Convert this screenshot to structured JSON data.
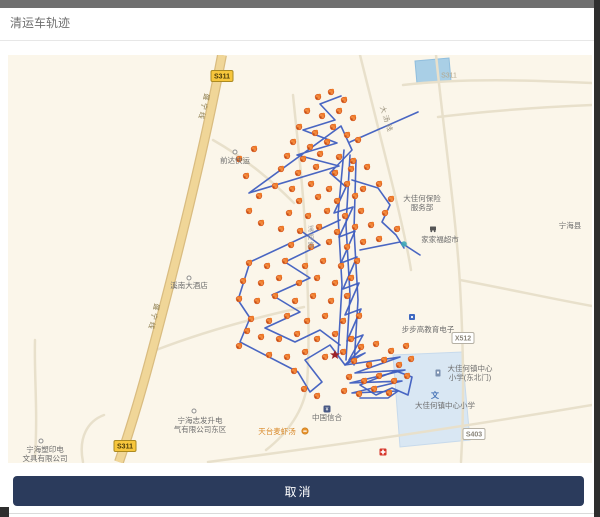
{
  "header": {
    "title": "清运车轨迹"
  },
  "footer": {
    "cancel_label": "取消"
  },
  "map": {
    "background": "#fbf6ea",
    "trajectory_color": "#3f5ec0",
    "marker_color": "#f28a3e",
    "road_badges": [
      {
        "label": "S311",
        "type": "provincial",
        "x": 214,
        "y": 21
      },
      {
        "label": "S311",
        "type": "provincial",
        "x": 117,
        "y": 391
      },
      {
        "label": "S311",
        "type": "plain",
        "x": 441,
        "y": 20
      },
      {
        "label": "X512",
        "type": "county",
        "x": 455,
        "y": 283
      },
      {
        "label": "S403",
        "type": "county",
        "x": 466,
        "y": 379
      }
    ],
    "road_names": [
      {
        "text": "盛宁线",
        "x": 197,
        "y": 38,
        "angle": 104,
        "vertical": false,
        "color": "#8a7a4a"
      },
      {
        "text": "盛宁线",
        "x": 147,
        "y": 248,
        "angle": 104,
        "vertical": false,
        "color": "#8a7a4a"
      },
      {
        "text": "大汤线",
        "x": 372,
        "y": 52,
        "angle": 72,
        "vertical": false,
        "color": "#9a917c"
      },
      {
        "text": "溪南路",
        "x": 303,
        "y": 176,
        "angle": 0,
        "vertical": true,
        "color": "#9a9a9a"
      }
    ],
    "poi_labels": [
      {
        "lines": [
          "前达快运"
        ],
        "x": 227,
        "y": 108,
        "icon": "poi-dot"
      },
      {
        "lines": [
          "大佳何保险",
          "服务部"
        ],
        "x": 414,
        "y": 146,
        "icon": null
      },
      {
        "lines": [
          "家家福超市"
        ],
        "x": 432,
        "y": 187,
        "icon": "cart",
        "icon_x": 425,
        "icon_y": 174
      },
      {
        "lines": [
          "宁海县"
        ],
        "x": 562,
        "y": 173,
        "icon": null
      },
      {
        "lines": [
          "溪南大酒店"
        ],
        "x": 181,
        "y": 233,
        "icon": "poi-dot",
        "icon_x": 181,
        "icon_y": 223
      },
      {
        "lines": [
          "步步高教育电子"
        ],
        "x": 420,
        "y": 277,
        "icon": "edu",
        "icon_x": 404,
        "icon_y": 262
      },
      {
        "lines": [
          "大佳何镇中心",
          "小学(东北门)"
        ],
        "x": 462,
        "y": 316,
        "icon": "gate",
        "icon_x": 430,
        "icon_y": 318
      },
      {
        "lines": [
          "大佳何镇中心小学"
        ],
        "x": 437,
        "y": 353,
        "icon": "school",
        "icon_x": 427,
        "icon_y": 340
      },
      {
        "lines": [
          "中国信合"
        ],
        "x": 319,
        "y": 365,
        "icon": "bank"
      },
      {
        "lines": [
          "天台麦虾汤"
        ],
        "x": 269,
        "y": 379,
        "icon": "food",
        "icon_x": 297,
        "icon_y": 376,
        "color": "#d98a2b"
      },
      {
        "lines": [
          "宁海志发升电",
          "气有限公司东区"
        ],
        "x": 192,
        "y": 368,
        "icon": "poi-dot",
        "icon_x": 186,
        "icon_y": 356
      },
      {
        "lines": [
          "宁海塑印电",
          "文具有限公司"
        ],
        "x": 37,
        "y": 397,
        "icon": "poi-dot",
        "icon_x": 33,
        "icon_y": 386
      }
    ],
    "point_icons": [
      {
        "type": "star",
        "x": 327,
        "y": 300
      },
      {
        "type": "pharmacy",
        "x": 375,
        "y": 397
      },
      {
        "type": "water-dot",
        "x": 396,
        "y": 189
      }
    ],
    "trajectory_paths": [
      [
        [
          333,
          41
        ],
        [
          312,
          49
        ],
        [
          327,
          65
        ],
        [
          295,
          75
        ],
        [
          329,
          88
        ],
        [
          289,
          100
        ],
        [
          331,
          111
        ],
        [
          241,
          138
        ],
        [
          333,
          71
        ],
        [
          344,
          95
        ],
        [
          322,
          118
        ],
        [
          338,
          132
        ],
        [
          326,
          158
        ],
        [
          345,
          152
        ],
        [
          331,
          182
        ],
        [
          347,
          176
        ],
        [
          333,
          208
        ],
        [
          349,
          202
        ],
        [
          335,
          234
        ],
        [
          351,
          228
        ],
        [
          337,
          260
        ],
        [
          353,
          254
        ],
        [
          339,
          286
        ],
        [
          355,
          280
        ],
        [
          341,
          305
        ],
        [
          357,
          298
        ],
        [
          337,
          310
        ],
        [
          392,
          302
        ],
        [
          347,
          318
        ],
        [
          397,
          315
        ],
        [
          342,
          328
        ],
        [
          394,
          326
        ],
        [
          344,
          338
        ],
        [
          390,
          336
        ],
        [
          380,
          343
        ],
        [
          352,
          343
        ]
      ],
      [
        [
          332,
          165
        ],
        [
          242,
          207
        ],
        [
          230,
          245
        ],
        [
          242,
          263
        ],
        [
          232,
          287
        ],
        [
          290,
          317
        ],
        [
          302,
          337
        ],
        [
          314,
          327
        ],
        [
          297,
          305
        ],
        [
          322,
          290
        ],
        [
          337,
          310
        ],
        [
          352,
          295
        ]
      ],
      [
        [
          292,
          175
        ],
        [
          312,
          190
        ],
        [
          277,
          207
        ],
        [
          302,
          223
        ],
        [
          264,
          240
        ],
        [
          292,
          257
        ],
        [
          257,
          273
        ],
        [
          287,
          287
        ],
        [
          312,
          275
        ],
        [
          332,
          290
        ]
      ],
      [
        [
          342,
          87
        ],
        [
          410,
          57
        ]
      ],
      [
        [
          344,
          125
        ],
        [
          370,
          133
        ],
        [
          382,
          150
        ],
        [
          374,
          167
        ],
        [
          388,
          180
        ],
        [
          396,
          193
        ]
      ],
      [
        [
          352,
          195
        ],
        [
          392,
          187
        ],
        [
          412,
          200
        ]
      ],
      [
        [
          336,
          95
        ],
        [
          330,
          160
        ],
        [
          334,
          230
        ],
        [
          330,
          300
        ]
      ],
      [
        [
          342,
          100
        ],
        [
          338,
          170
        ],
        [
          342,
          240
        ],
        [
          338,
          305
        ]
      ],
      [
        [
          348,
          105
        ],
        [
          346,
          175
        ],
        [
          350,
          245
        ],
        [
          346,
          310
        ]
      ],
      [
        [
          352,
          330
        ],
        [
          368,
          340
        ],
        [
          384,
          333
        ],
        [
          400,
          340
        ],
        [
          404,
          322
        ],
        [
          388,
          316
        ],
        [
          372,
          322
        ],
        [
          352,
          330
        ]
      ]
    ],
    "markers": [
      [
        310,
        42
      ],
      [
        323,
        37
      ],
      [
        336,
        45
      ],
      [
        299,
        56
      ],
      [
        314,
        61
      ],
      [
        331,
        56
      ],
      [
        345,
        63
      ],
      [
        291,
        72
      ],
      [
        307,
        78
      ],
      [
        325,
        72
      ],
      [
        339,
        80
      ],
      [
        285,
        87
      ],
      [
        302,
        92
      ],
      [
        319,
        87
      ],
      [
        350,
        85
      ],
      [
        279,
        101
      ],
      [
        295,
        104
      ],
      [
        312,
        99
      ],
      [
        331,
        102
      ],
      [
        345,
        106
      ],
      [
        273,
        114
      ],
      [
        290,
        118
      ],
      [
        308,
        112
      ],
      [
        327,
        118
      ],
      [
        343,
        114
      ],
      [
        359,
        112
      ],
      [
        267,
        131
      ],
      [
        284,
        134
      ],
      [
        303,
        129
      ],
      [
        321,
        134
      ],
      [
        339,
        129
      ],
      [
        355,
        134
      ],
      [
        291,
        146
      ],
      [
        310,
        142
      ],
      [
        329,
        146
      ],
      [
        347,
        141
      ],
      [
        231,
        104
      ],
      [
        246,
        94
      ],
      [
        238,
        121
      ],
      [
        251,
        141
      ],
      [
        241,
        156
      ],
      [
        253,
        168
      ],
      [
        371,
        129
      ],
      [
        383,
        144
      ],
      [
        377,
        158
      ],
      [
        389,
        174
      ],
      [
        281,
        158
      ],
      [
        300,
        161
      ],
      [
        319,
        156
      ],
      [
        337,
        161
      ],
      [
        353,
        156
      ],
      [
        273,
        174
      ],
      [
        292,
        176
      ],
      [
        311,
        172
      ],
      [
        329,
        177
      ],
      [
        347,
        172
      ],
      [
        363,
        170
      ],
      [
        283,
        190
      ],
      [
        303,
        192
      ],
      [
        321,
        187
      ],
      [
        339,
        192
      ],
      [
        355,
        187
      ],
      [
        371,
        184
      ],
      [
        241,
        208
      ],
      [
        259,
        211
      ],
      [
        277,
        206
      ],
      [
        297,
        211
      ],
      [
        315,
        206
      ],
      [
        333,
        211
      ],
      [
        349,
        206
      ],
      [
        235,
        226
      ],
      [
        253,
        228
      ],
      [
        271,
        223
      ],
      [
        291,
        228
      ],
      [
        309,
        223
      ],
      [
        327,
        228
      ],
      [
        343,
        223
      ],
      [
        231,
        244
      ],
      [
        249,
        246
      ],
      [
        267,
        241
      ],
      [
        287,
        246
      ],
      [
        305,
        241
      ],
      [
        323,
        246
      ],
      [
        339,
        241
      ],
      [
        243,
        264
      ],
      [
        261,
        266
      ],
      [
        279,
        261
      ],
      [
        299,
        266
      ],
      [
        317,
        261
      ],
      [
        335,
        266
      ],
      [
        351,
        261
      ],
      [
        253,
        282
      ],
      [
        271,
        284
      ],
      [
        289,
        279
      ],
      [
        309,
        284
      ],
      [
        327,
        279
      ],
      [
        343,
        284
      ],
      [
        261,
        300
      ],
      [
        279,
        302
      ],
      [
        297,
        297
      ],
      [
        317,
        302
      ],
      [
        335,
        297
      ],
      [
        353,
        292
      ],
      [
        368,
        289
      ],
      [
        383,
        296
      ],
      [
        398,
        291
      ],
      [
        346,
        306
      ],
      [
        361,
        310
      ],
      [
        376,
        305
      ],
      [
        391,
        310
      ],
      [
        403,
        304
      ],
      [
        341,
        322
      ],
      [
        356,
        326
      ],
      [
        371,
        321
      ],
      [
        386,
        326
      ],
      [
        399,
        321
      ],
      [
        336,
        336
      ],
      [
        351,
        339
      ],
      [
        366,
        334
      ],
      [
        381,
        338
      ],
      [
        239,
        276
      ],
      [
        231,
        291
      ],
      [
        286,
        316
      ],
      [
        296,
        334
      ],
      [
        309,
        341
      ]
    ]
  }
}
